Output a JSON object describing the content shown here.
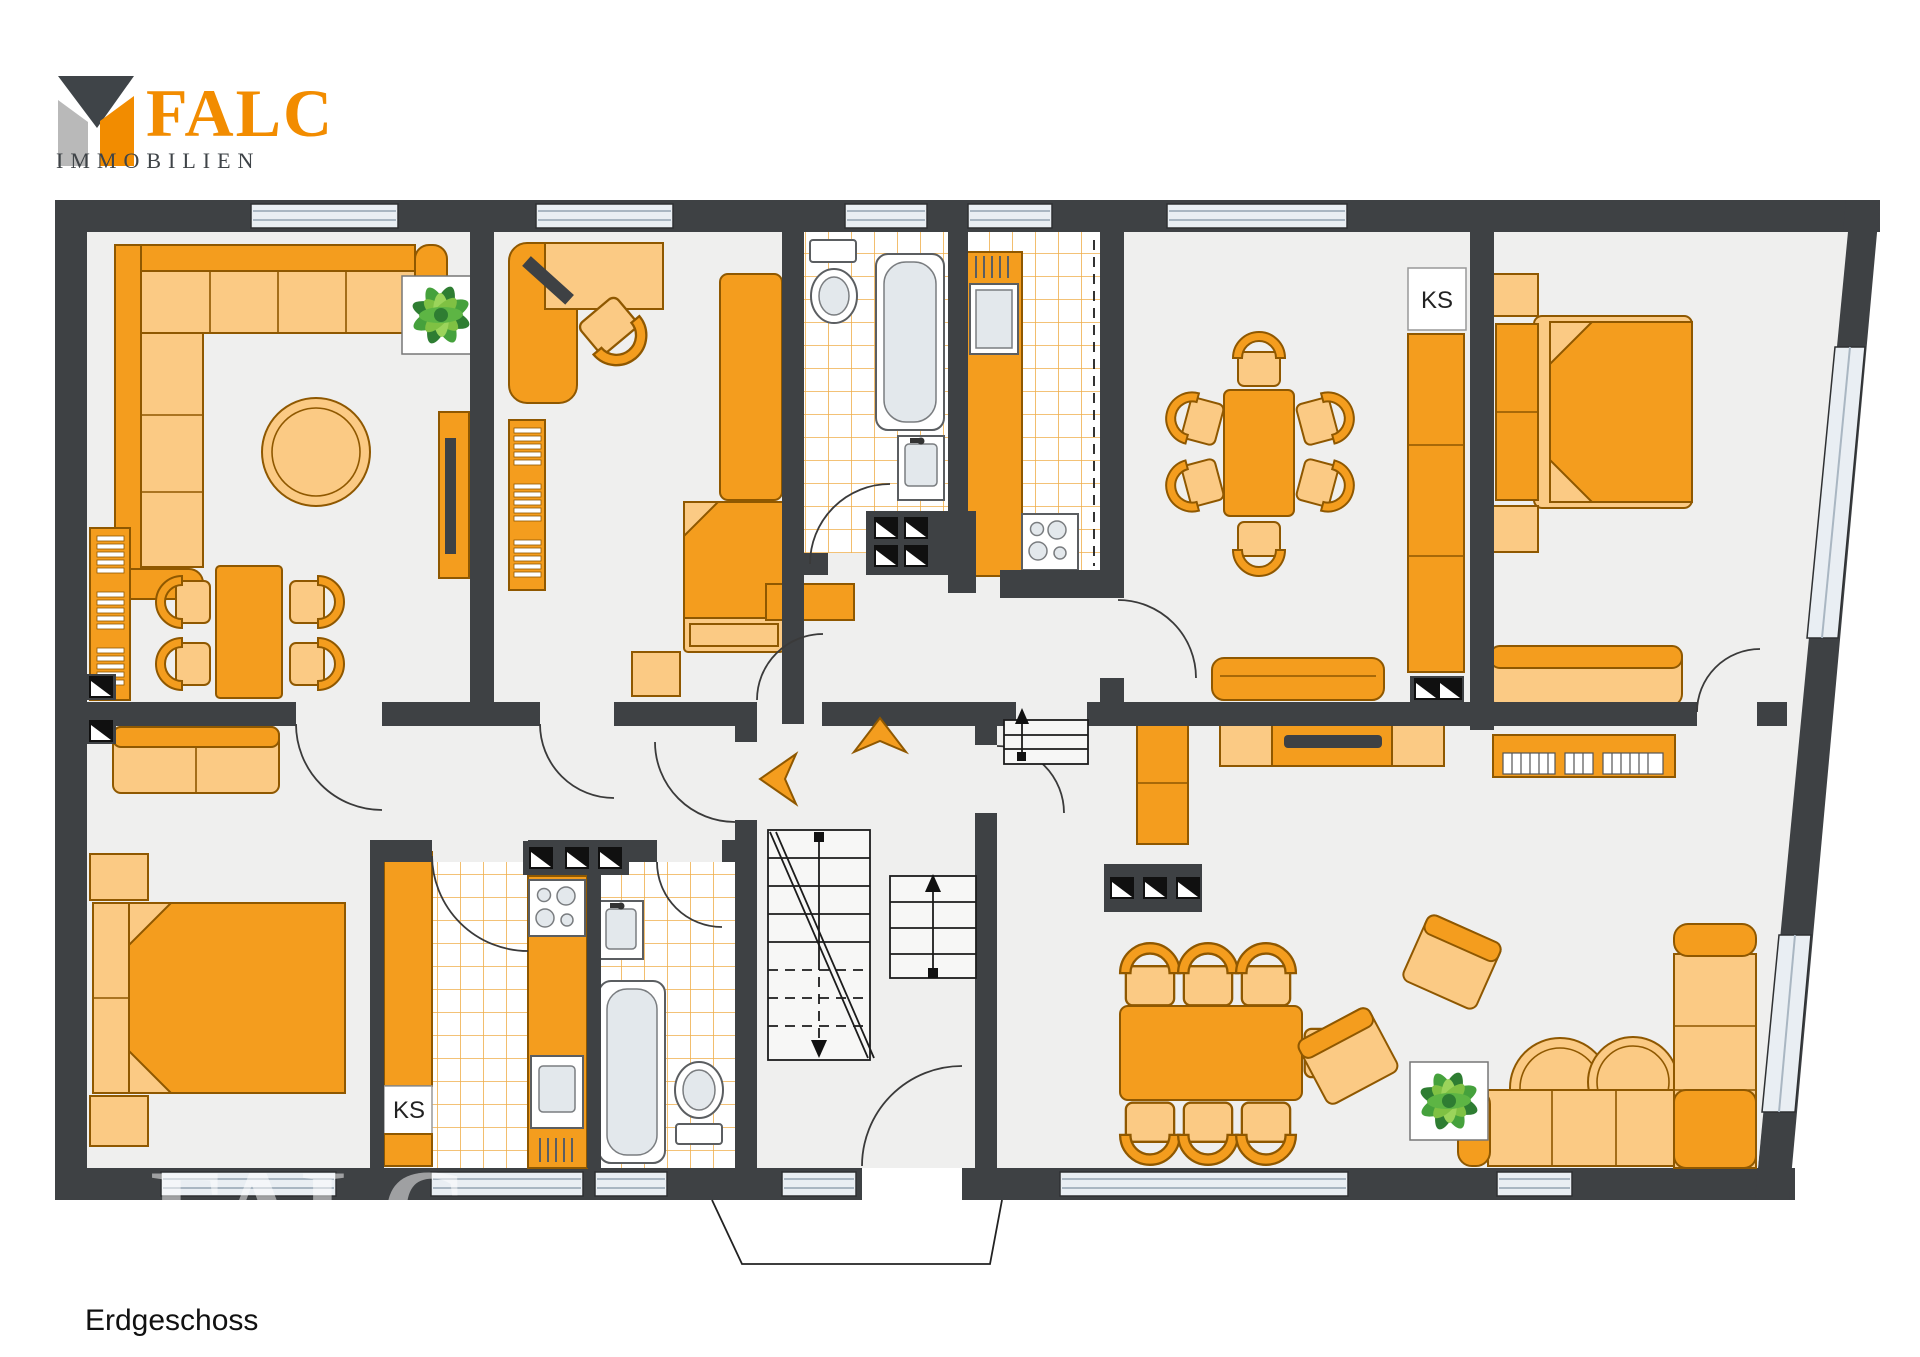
{
  "logo": {
    "brand": "FALC",
    "subtitle": "IMMOBILIEN",
    "brand_color": "#F28C00",
    "subtitle_color": "#3F4448"
  },
  "watermark": "FALC",
  "plan": {
    "floor_label": "Erdgeschoss",
    "fridge_label_dining": "KS",
    "fridge_label_kitchen": "KS",
    "colors": {
      "wall": "#3E4144",
      "floor": "#EFEFEE",
      "furniture": "#F49D1E",
      "furniture_light": "#FBCA84",
      "tile_line": "#EFAE4A",
      "window": "#E9EEF3",
      "plant_green": "#4FA83D"
    },
    "rooms": [
      {
        "name": "Wohnzimmer oben links",
        "furniture": [
          "Ecksofa",
          "runder Couchtisch",
          "Wandregal",
          "Esstisch mit 4 Stühlen",
          "TV-Sideboard",
          "Pflanze"
        ]
      },
      {
        "name": "Arbeits-/Schlafzimmer oben",
        "furniture": [
          "Eckschreibtisch mit Stuhl",
          "Kleiderschrank",
          "Regal",
          "Einzelbett",
          "Nachttisch"
        ]
      },
      {
        "name": "Bad oben",
        "furniture": [
          "WC",
          "Badewanne",
          "Waschbecken",
          "Installationsschacht"
        ]
      },
      {
        "name": "Küche oben",
        "furniture": [
          "Kühlschrank",
          "Küchenzeile",
          "Herd"
        ]
      },
      {
        "name": "Esszimmer",
        "furniture": [
          "Esstisch mit 6 Stühlen",
          "Hochschrank",
          "Kühlschrank KS",
          "Sitzbank"
        ]
      },
      {
        "name": "Schlafzimmer oben rechts",
        "furniture": [
          "Doppelbett",
          "2 Nachttische",
          "Sofa"
        ]
      },
      {
        "name": "Flur unten links",
        "furniture": [
          "2er-Sofa",
          "Sideboard"
        ]
      },
      {
        "name": "Schlafzimmer unten links",
        "furniture": [
          "Doppelbett",
          "2 Nachttische"
        ]
      },
      {
        "name": "Küche unten",
        "furniture": [
          "Kühlschrank KS",
          "Herd",
          "Spüle",
          "Küchenschränke"
        ]
      },
      {
        "name": "Bad unten",
        "furniture": [
          "Waschbecken",
          "Badewanne",
          "WC"
        ]
      },
      {
        "name": "Treppenhaus",
        "furniture": [
          "Treppe abwärts",
          "Treppe aufwärts",
          "Hauseingang",
          "Richtungspfeile"
        ]
      },
      {
        "name": "Wohn-/Esszimmer unten rechts",
        "furniture": [
          "TV-Sideboard",
          "Klavier",
          "Esstisch mit 7 Stühlen",
          "2 Sessel",
          "2 Beistelltische",
          "Ecksofa",
          "Schrank",
          "Pflanze",
          "Stufen"
        ]
      }
    ]
  }
}
